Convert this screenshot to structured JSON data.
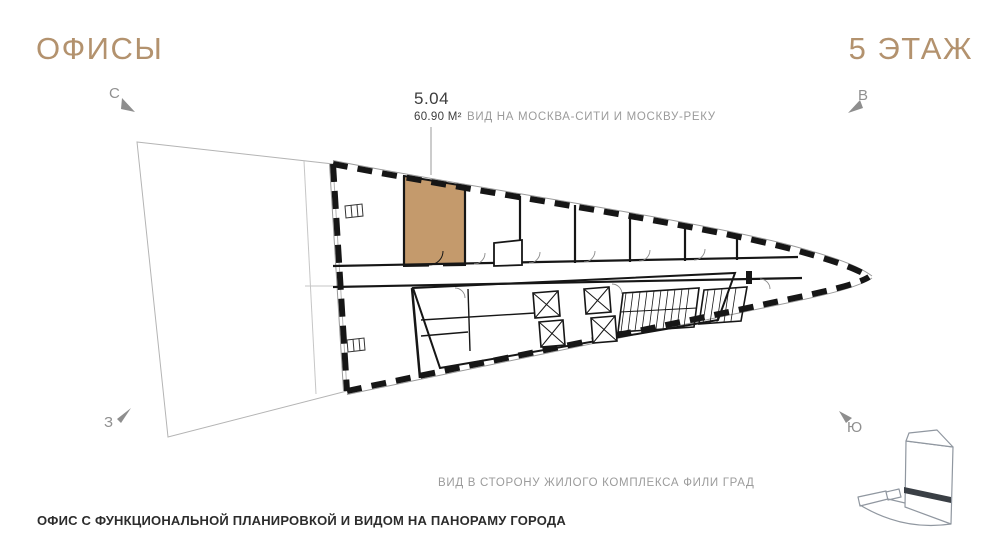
{
  "header": {
    "offices_title": "ОФИСЫ",
    "floor_title": "5 ЭТАЖ"
  },
  "unit": {
    "number": "5.04",
    "area": "60.90 М²"
  },
  "view_labels": {
    "north_side": "ВИД НА МОСКВА-СИТИ И МОСКВУ-РЕКУ",
    "south_side": "ВИД В СТОРОНУ ЖИЛОГО КОМПЛЕКСА ФИЛИ ГРАД"
  },
  "compass": {
    "north": "С",
    "east": "В",
    "west": "З",
    "south": "Ю"
  },
  "footer": {
    "caption": "ОФИС С ФУНКЦИОНАЛЬНОЙ ПЛАНИРОВКОЙ И ВИДОМ НА ПАНОРАМУ ГОРОДА"
  },
  "colors": {
    "accent_gold": "#b3926e",
    "unit_highlight": "#c49a6c",
    "label_gray": "#9b9b9b",
    "wall_black": "#161616"
  }
}
